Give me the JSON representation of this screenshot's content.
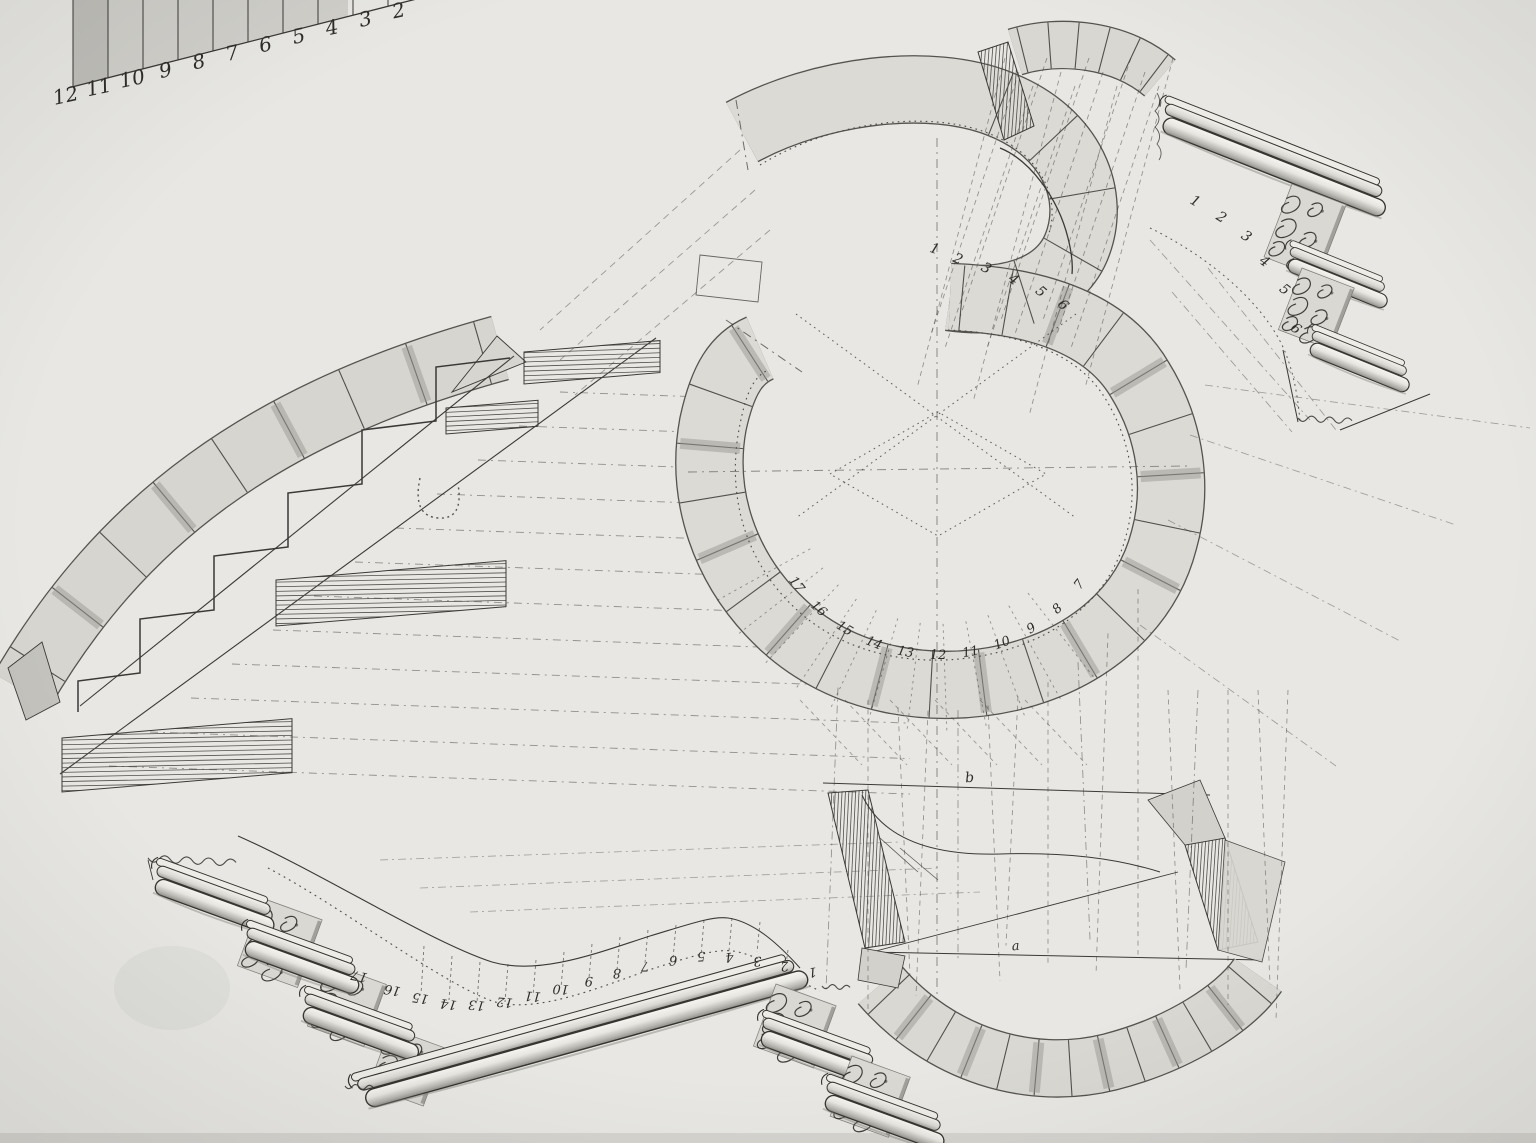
{
  "drawing": {
    "description": "Ink-and-wash construction drawing of a curved staircase: serpentine plan of winding treads, developments of the strings, and stepped handrail moldings with rocaille consoles",
    "colors": {
      "paper": "#e8e7e3",
      "ink": "#3a3937",
      "wash": "#dbdad4",
      "wash_dark": "#b7b6b0",
      "shadow": "#8f8e88"
    },
    "scale_gauge": {
      "labels": [
        "12",
        "11",
        "10",
        "9",
        "8",
        "7",
        "6",
        "5",
        "4",
        "3",
        "2"
      ]
    },
    "upper_flight": {
      "labels": [
        "1",
        "2",
        "3",
        "4",
        "5",
        "6"
      ]
    },
    "spiral_plan": {
      "entry_labels": [
        "1",
        "2",
        "3",
        "4",
        "5",
        "6"
      ],
      "tread_labels": [
        "7",
        "8",
        "9",
        "10",
        "11",
        "12",
        "13",
        "14",
        "15",
        "16",
        "17"
      ]
    },
    "lower_development": {
      "labels": [
        "1",
        "2",
        "3",
        "4",
        "5",
        "6",
        "7",
        "8",
        "9",
        "10",
        "11",
        "12",
        "13",
        "14",
        "15",
        "16",
        "17"
      ]
    },
    "reference_marks": [
      "b",
      "a"
    ]
  }
}
